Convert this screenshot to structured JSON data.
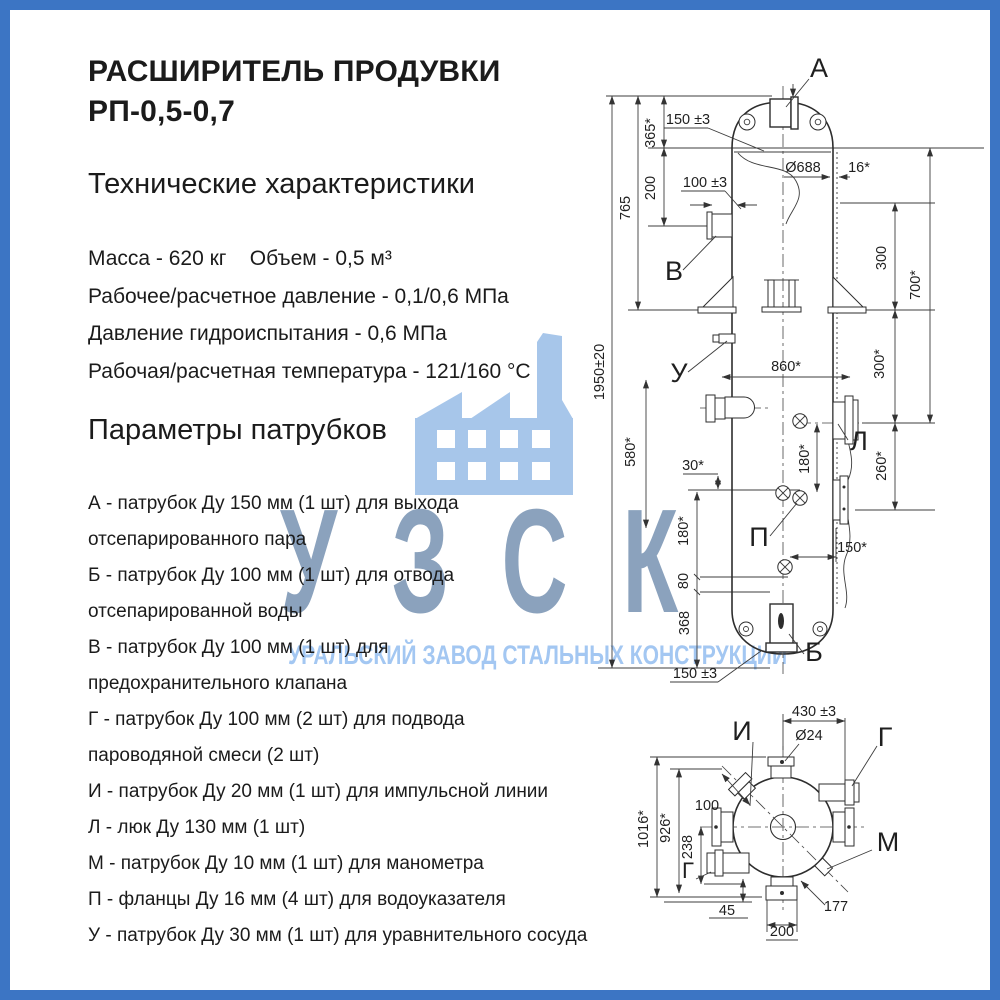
{
  "page": {
    "background": "#ffffff",
    "border_color": "#3c75c4"
  },
  "header": {
    "title_line1": "РАСШИРИТЕЛЬ ПРОДУВКИ",
    "title_line2": "РП-0,5-0,7",
    "section_specs": "Технические характеристики",
    "section_nozzles": "Параметры патрубков"
  },
  "specs": [
    "Масса - 620 кг    Объем - 0,5 м³",
    "Рабочее/расчетное давление - 0,1/0,6 МПа",
    "Давление гидроиспытания - 0,6 МПа",
    "Рабочая/расчетная температура - 121/160 °С"
  ],
  "nozzle_lines": [
    "А - патрубок Ду 150 мм (1 шт) для выхода",
    "отсепарированного пара",
    "Б - патрубок Ду 100 мм (1 шт)  для отвода",
    "отсепарированной воды",
    "В - патрубок Ду 100 мм (1 шт) для",
    "предохранительного клапана",
    "Г - патрубок Ду 100 мм (2 шт) для подвода",
    "пароводяной смеси (2 шт)",
    "И - патрубок Ду 20 мм (1 шт) для импульсной линии",
    "Л - люк Ду 130 мм (1 шт)",
    "М - патрубок Ду 10 мм (1 шт) для манометра",
    "П - фланцы Ду 16 мм (4 шт) для водоуказателя",
    "У - патрубок Ду 30 мм (1 шт) для уравнительного сосуда"
  ],
  "watermark": {
    "abbr": "УЗСК",
    "tagline": "УРАЛЬСКИЙ ЗАВОД СТАЛЬНЫХ КОНСТРУКЦИЙ",
    "icon": "factory-icon",
    "icon_color": "#a7c6ea",
    "abbr_color": "#8ba2bd",
    "tagline_color": "#a3c7f2"
  },
  "drawing": {
    "front_view": {
      "ports": {
        "a": "А",
        "b": "Б",
        "v": "В",
        "u": "У",
        "l": "Л",
        "p": "П"
      },
      "dims": {
        "top_offset": "150 ±3",
        "d365": "365*",
        "d200": "200",
        "d765": "765",
        "d100": "100 ±3",
        "total_height": "1950±20",
        "d580": "580*",
        "d860": "860*",
        "d30": "30*",
        "d180_center": "180*",
        "d180_left": "180*",
        "d80": "80",
        "d368": "368",
        "bottom_offset": "150 ±3",
        "d150_right": "150*",
        "diameter": "Ø688",
        "wall_thickness": "16*",
        "d300_upper": "300",
        "d700": "700*",
        "d300_lower": "300*",
        "d260": "260*"
      }
    },
    "top_view": {
      "ports": {
        "i": "И",
        "g_right": "Г",
        "g_left": "Г",
        "m": "М"
      },
      "dims": {
        "d430": "430 ±3",
        "dia24": "Ø24",
        "d100": "100",
        "d1016": "1016*",
        "d926": "926*",
        "d238": "238",
        "d45": "45",
        "d200": "200",
        "d177": "177"
      }
    }
  }
}
